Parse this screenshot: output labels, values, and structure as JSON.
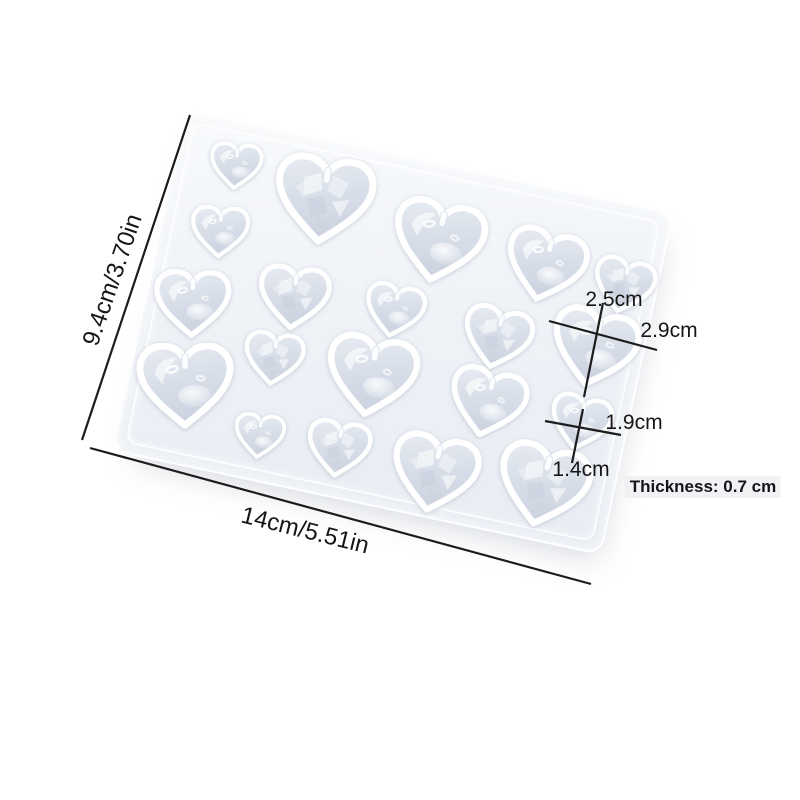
{
  "annotations": {
    "height_label": "9.4cm/3.70in",
    "width_label": "14cm/5.51in",
    "large_heart_height": "2.5cm",
    "large_heart_width": "2.9cm",
    "small_heart_width": "1.9cm",
    "small_heart_height": "1.4cm",
    "thickness_label": "Thickness: 0.7 cm"
  },
  "colors": {
    "background": "#ffffff",
    "dimension_line": "#1c1c1c",
    "dimension_text": "#161616",
    "mold_surface": "#eff2f7",
    "cavity_fill": "#d9dfe9",
    "cavity_rim": "#ffffff"
  },
  "product": {
    "name": "heart pendant silicone resin mold",
    "mold": {
      "rows": 4,
      "heart_count": 20,
      "hearts": [
        {
          "x": 62,
          "y": 46,
          "w": 54,
          "finish": "smooth",
          "r": -6
        },
        {
          "x": 155,
          "y": 62,
          "w": 102,
          "finish": "faceted",
          "r": -4
        },
        {
          "x": 275,
          "y": 79,
          "w": 95,
          "finish": "smooth",
          "r": 0
        },
        {
          "x": 385,
          "y": 80,
          "w": 84,
          "finish": "smooth",
          "r": 3
        },
        {
          "x": 466,
          "y": 83,
          "w": 64,
          "finish": "faceted",
          "r": 2
        },
        {
          "x": 60,
          "y": 114,
          "w": 60,
          "finish": "smooth",
          "r": -8
        },
        {
          "x": 146,
          "y": 163,
          "w": 74,
          "finish": "faceted",
          "r": -5
        },
        {
          "x": 247,
          "y": 155,
          "w": 62,
          "finish": "smooth",
          "r": 0
        },
        {
          "x": 353,
          "y": 160,
          "w": 72,
          "finish": "faceted",
          "r": 2
        },
        {
          "x": 450,
          "y": 150,
          "w": 90,
          "finish": "smooth",
          "r": 2
        },
        {
          "x": 48,
          "y": 190,
          "w": 78,
          "finish": "smooth",
          "r": -10
        },
        {
          "x": 139,
          "y": 227,
          "w": 62,
          "finish": "faceted",
          "r": -4
        },
        {
          "x": 238,
          "y": 224,
          "w": 94,
          "finish": "smooth",
          "r": -2
        },
        {
          "x": 357,
          "y": 226,
          "w": 80,
          "finish": "smooth",
          "r": 2
        },
        {
          "x": 452,
          "y": 226,
          "w": 64,
          "finish": "smooth",
          "r": 2
        },
        {
          "x": 58,
          "y": 272,
          "w": 98,
          "finish": "smooth",
          "r": -12
        },
        {
          "x": 141,
          "y": 305,
          "w": 52,
          "finish": "smooth",
          "r": -5
        },
        {
          "x": 221,
          "y": 302,
          "w": 66,
          "finish": "faceted",
          "r": -3
        },
        {
          "x": 320,
          "y": 306,
          "w": 90,
          "finish": "faceted",
          "r": 0
        },
        {
          "x": 428,
          "y": 296,
          "w": 95,
          "finish": "faceted",
          "r": 2
        }
      ]
    }
  }
}
